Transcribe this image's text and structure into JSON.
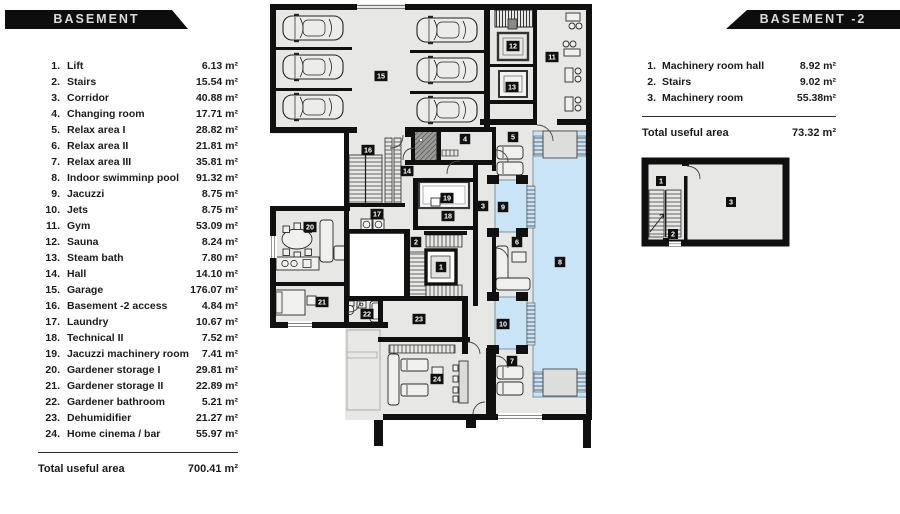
{
  "banners": {
    "basement": "BASEMENT",
    "basement2": "BASEMENT -2"
  },
  "basement_list": {
    "items": [
      {
        "n": "1.",
        "name": "Lift",
        "area": "6.13 m²"
      },
      {
        "n": "2.",
        "name": "Stairs",
        "area": "15.54 m²"
      },
      {
        "n": "3.",
        "name": "Corridor",
        "area": "40.88 m²"
      },
      {
        "n": "4.",
        "name": "Changing room",
        "area": "17.71 m²"
      },
      {
        "n": "5.",
        "name": "Relax area I",
        "area": "28.82 m²"
      },
      {
        "n": "6.",
        "name": "Relax area II",
        "area": "21.81 m²"
      },
      {
        "n": "7.",
        "name": "Relax area III",
        "area": "35.81 m²"
      },
      {
        "n": "8.",
        "name": "Indoor swimminp pool",
        "area": "91.32 m²"
      },
      {
        "n": "9.",
        "name": "Jacuzzi",
        "area": "8.75 m²"
      },
      {
        "n": "10.",
        "name": "Jets",
        "area": "8.75 m²"
      },
      {
        "n": "11.",
        "name": "Gym",
        "area": "53.09 m²"
      },
      {
        "n": "12.",
        "name": "Sauna",
        "area": "8.24 m²"
      },
      {
        "n": "13.",
        "name": "Steam bath",
        "area": "7.80 m²"
      },
      {
        "n": "14.",
        "name": "Hall",
        "area": "14.10 m²"
      },
      {
        "n": "15.",
        "name": "Garage",
        "area": "176.07 m²"
      },
      {
        "n": "16.",
        "name": "Basement -2 access",
        "area": "4.84 m²"
      },
      {
        "n": "17.",
        "name": "Laundry",
        "area": "10.67 m²"
      },
      {
        "n": "18.",
        "name": "Technical II",
        "area": "7.52 m²"
      },
      {
        "n": "19.",
        "name": "Jacuzzi machinery room",
        "area": "7.41 m²"
      },
      {
        "n": "20.",
        "name": "Gardener storage I",
        "area": "29.81 m²"
      },
      {
        "n": "21.",
        "name": "Gardener storage II",
        "area": "22.89 m²"
      },
      {
        "n": "22.",
        "name": "Gardener bathroom",
        "area": "5.21 m²"
      },
      {
        "n": "23.",
        "name": "Dehumidifier",
        "area": "21.27 m²"
      },
      {
        "n": "24.",
        "name": "Home cinema / bar",
        "area": "55.97 m²"
      }
    ],
    "total_label": "Total useful area",
    "total_value": "700.41 m²"
  },
  "basement2_list": {
    "items": [
      {
        "n": "1.",
        "name": "Machinery room hall",
        "area": "8.92 m²"
      },
      {
        "n": "2.",
        "name": "Stairs",
        "area": "9.02 m²"
      },
      {
        "n": "3.",
        "name": "Machinery room",
        "area": "55.38m²"
      }
    ],
    "total_label": "Total useful area",
    "total_value": "73.32 m²"
  },
  "plan": {
    "badges": {
      "r1": "1",
      "r2": "2",
      "r3": "3",
      "r4": "4",
      "r5": "5",
      "r6": "6",
      "r7": "7",
      "r8": "8",
      "r9": "9",
      "r10": "10",
      "r11": "11",
      "r12": "12",
      "r13": "13",
      "r14": "14",
      "r15": "15",
      "r16": "16",
      "r17": "17",
      "r18": "18",
      "r19": "19",
      "r20": "20",
      "r21": "21",
      "r22": "22",
      "r23": "23",
      "r24": "24"
    }
  },
  "plan2": {
    "badges": {
      "r1": "1",
      "r2": "2",
      "r3": "3"
    }
  },
  "colors": {
    "wall": "#101010",
    "floor": "#e7e7e5",
    "pool": "#c9e4f5",
    "banner": "#0d0d0d"
  }
}
